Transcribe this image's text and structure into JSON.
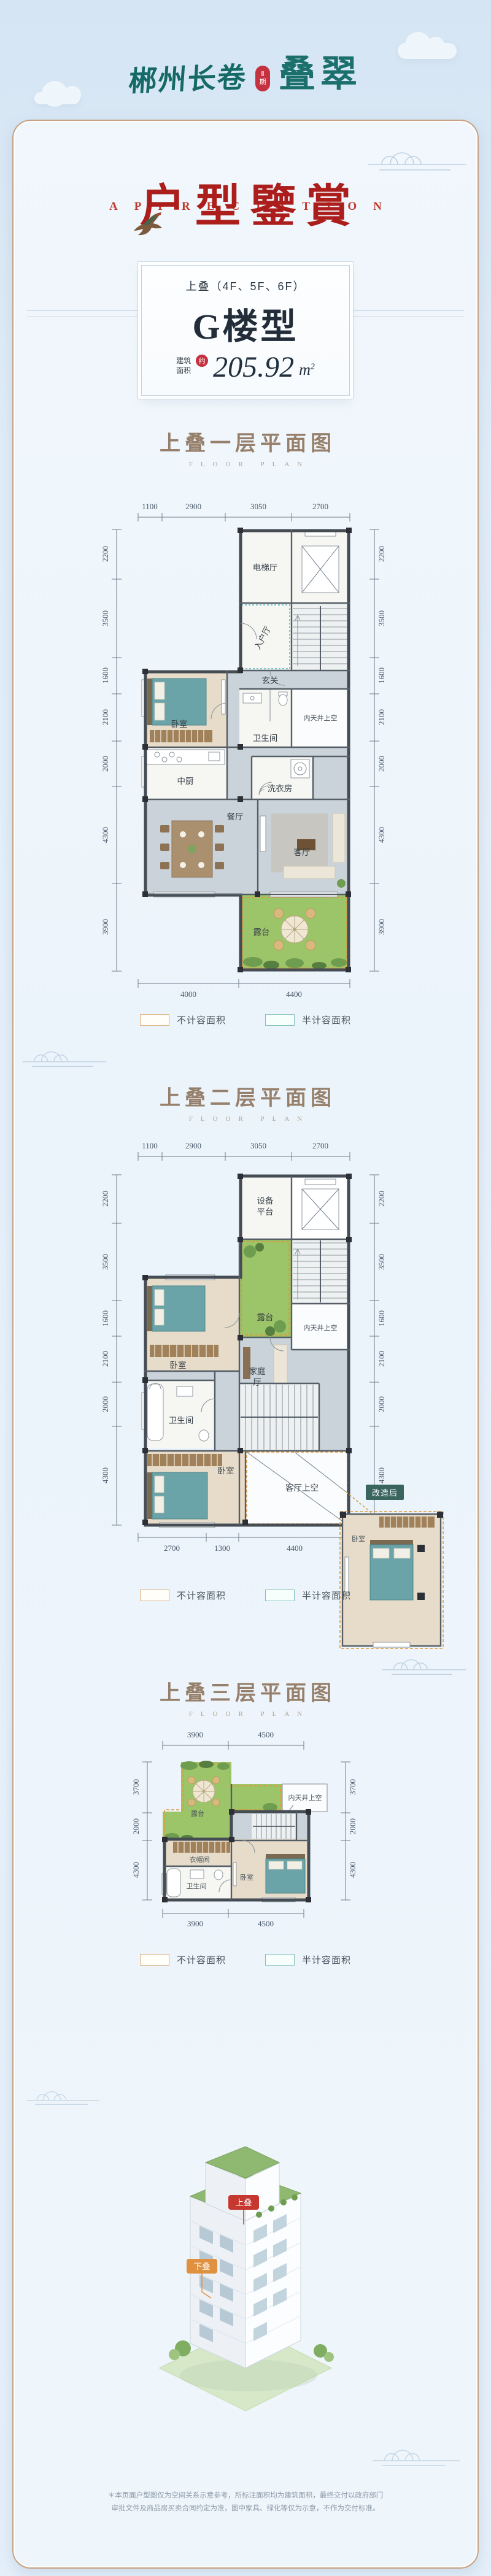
{
  "logo": {
    "brand": "郴州长卷",
    "seal_top": "Ⅱ",
    "seal_bottom": "期",
    "product": "叠翠"
  },
  "hero": {
    "letters": [
      "A",
      "P",
      "P",
      "R",
      "E",
      "C",
      "I",
      "A",
      "T",
      "I",
      "O",
      "N"
    ],
    "title": "户型鑒賞"
  },
  "badge": {
    "stack": "上叠（4F、5F、6F）",
    "name": "G楼型",
    "area_label_top": "建筑",
    "area_label_bottom": "面积",
    "area_seal": "约",
    "area_value": "205.92",
    "area_unit": "m",
    "area_unit_sup": "2"
  },
  "legend": {
    "non_counted": "不计容面积",
    "half_counted": "半计容面积"
  },
  "sections": [
    {
      "title": "上叠一层平面图",
      "subtitle": "FLOOR PLAN",
      "rooms": {
        "elevator_hall": "电梯厅",
        "entry_hall": "入户厅",
        "foyer": "玄关",
        "bedroom": "卧室",
        "bath": "卫生间",
        "lightwell": "内天井上空",
        "kitchen": "中厨",
        "laundry": "洗衣房",
        "dining": "餐厅",
        "living": "客厅",
        "terrace": "露台"
      },
      "dims": {
        "top": [
          "1100",
          "2900",
          "3050",
          "2700"
        ],
        "bottom": [
          "4000",
          "4400"
        ],
        "left": [
          "2200",
          "3500",
          "1600",
          "2100",
          "2000",
          "4300",
          "3900"
        ],
        "right": [
          "2200",
          "3500",
          "1600",
          "2100",
          "2000",
          "4300",
          "3900"
        ]
      }
    },
    {
      "title": "上叠二层平面图",
      "subtitle": "FLOOR PLAN",
      "rooms": {
        "equip_top": "设备",
        "equip_bottom": "平台",
        "terrace": "露台",
        "bedroom_upper": "卧室",
        "family_top": "家庭",
        "family_bottom": "厅",
        "lightwell": "内天井上空",
        "bath": "卫生间",
        "bedroom_lower": "卧室",
        "living_void": "客厅上空"
      },
      "inset": {
        "tag": "改造后",
        "room": "卧室"
      },
      "dims": {
        "top": [
          "1100",
          "2900",
          "3050",
          "2700"
        ],
        "bottom": [
          "2700",
          "1300",
          "4400"
        ],
        "left": [
          "2200",
          "3500",
          "1600",
          "2100",
          "2000",
          "4300"
        ],
        "right": [
          "2200",
          "3500",
          "1600",
          "2100",
          "2000",
          "4300"
        ]
      }
    },
    {
      "title": "上叠三层平面图",
      "subtitle": "FLOOR PLAN",
      "rooms": {
        "terrace": "露台",
        "lightwell": "内天井上空",
        "cloak": "衣帽间",
        "bath": "卫生间",
        "bedroom": "卧室"
      },
      "dims": {
        "top": [
          "3900",
          "4500"
        ],
        "bottom": [
          "3900",
          "4500"
        ],
        "left": [
          "3700",
          "2000",
          "4300"
        ],
        "right": [
          "3700",
          "2000",
          "4300"
        ]
      }
    }
  ],
  "building": {
    "tag_upper": "上叠",
    "tag_lower": "下叠"
  },
  "footer": {
    "line1": "＊本页面户型图仅为空间关系示意参考，所标注面积均为建筑面积，最终交付以政府部门",
    "line2": "审批文件及商品房买卖合同约定为准，图中家具、绿化等仅为示意，不作为交付标准。"
  },
  "colors": {
    "brand_teal": "#1b6f6c",
    "seal_red": "#c5313f",
    "title_red": "#ab1e1c",
    "section_brown": "#96806b",
    "terrace_green": "#9cc468",
    "legend_tan": "#d9b17e",
    "legend_teal": "#7ec0b8"
  }
}
